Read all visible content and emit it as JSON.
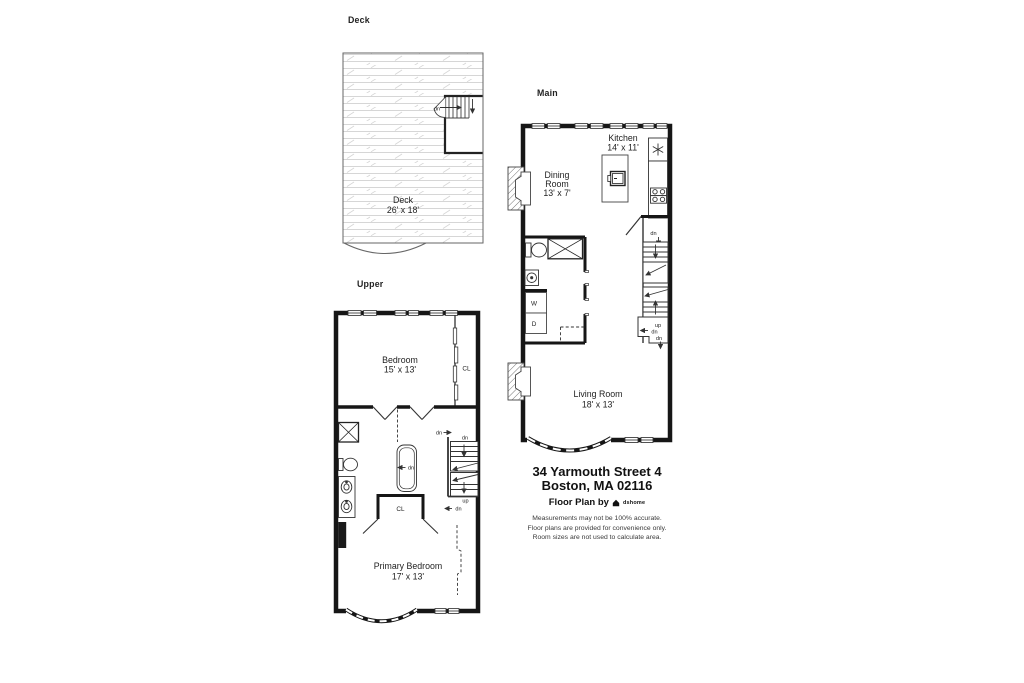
{
  "floors": {
    "deck": {
      "title": "Deck",
      "room_name": "Deck",
      "room_dims": "26' x 18'",
      "stair_dn": "dn"
    },
    "upper": {
      "title": "Upper",
      "bedroom_name": "Bedroom",
      "bedroom_dims": "15' x 13'",
      "closet_right": "CL",
      "closet_center": "CL",
      "primary_name": "Primary Bedroom",
      "primary_dims": "17' x 13'",
      "labels": {
        "hall_dn": "dn",
        "stair_top_dn": "dn",
        "tub_dn": "dn",
        "up": "up",
        "lower_dn": "dn"
      }
    },
    "main": {
      "title": "Main",
      "kitchen_name": "Kitchen",
      "kitchen_dims": "14' x 11'",
      "dining_line1": "Dining",
      "dining_line2": "Room",
      "dining_dims": "13' x 7'",
      "living_name": "Living Room",
      "living_dims": "18' x 13'",
      "washer": "W",
      "dryer": "D",
      "labels": {
        "stair_top_dn": "dn",
        "up": "up",
        "mid_dn": "dn",
        "bottom_dn": "dn"
      }
    }
  },
  "footer": {
    "address_line1": "34 Yarmouth Street 4",
    "address_line2": "Boston, MA 02116",
    "credit": "Floor Plan by",
    "brand": "dshome",
    "disclaimer_line1": "Measurements may not be 100% accurate.",
    "disclaimer_line2": "Floor plans are provided for convenience only.",
    "disclaimer_line3": "Room sizes are not used to calculate area."
  }
}
